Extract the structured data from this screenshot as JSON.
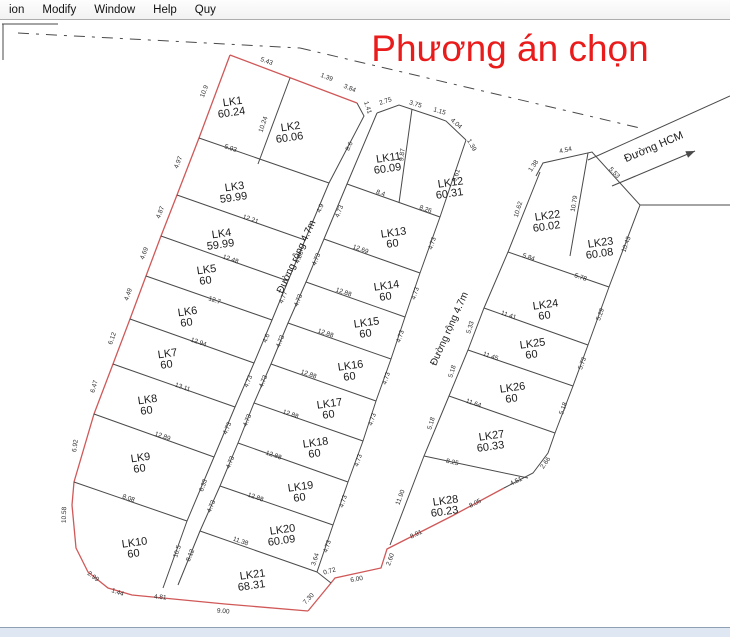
{
  "menu": {
    "items": [
      "ion",
      "Modify",
      "Window",
      "Help",
      "Quy"
    ]
  },
  "title": {
    "text": "Phương án chọn",
    "color": "#ea1b1b"
  },
  "colors": {
    "boundary_red": "#d05858",
    "line_black": "#4a4a4a",
    "bg": "#ffffff"
  },
  "road_labels": [
    {
      "name": "road-1-label",
      "text": "Đường rộng 4.7m",
      "x": 299,
      "y": 258,
      "r": -65
    },
    {
      "name": "road-2-label",
      "text": "Đường rộng 4.7m",
      "x": 452,
      "y": 330,
      "r": -66
    },
    {
      "name": "road-hcm-label",
      "text": "Đường HCM",
      "x": 655,
      "y": 150,
      "r": -23
    }
  ],
  "lots": [
    {
      "id": "LK1",
      "area": "60.24",
      "x": 233,
      "y": 105
    },
    {
      "id": "LK2",
      "area": "60.06",
      "x": 291,
      "y": 130
    },
    {
      "id": "LK3",
      "area": "59.99",
      "x": 235,
      "y": 190
    },
    {
      "id": "LK4",
      "area": "59.99",
      "x": 222,
      "y": 237
    },
    {
      "id": "LK5",
      "area": "60",
      "x": 207,
      "y": 273
    },
    {
      "id": "LK6",
      "area": "60",
      "x": 188,
      "y": 315
    },
    {
      "id": "LK7",
      "area": "60",
      "x": 168,
      "y": 357
    },
    {
      "id": "LK8",
      "area": "60",
      "x": 148,
      "y": 403
    },
    {
      "id": "LK9",
      "area": "60",
      "x": 141,
      "y": 461
    },
    {
      "id": "LK10",
      "area": "60",
      "x": 135,
      "y": 546
    },
    {
      "id": "LK11",
      "area": "60.09",
      "x": 389,
      "y": 161
    },
    {
      "id": "LK12",
      "area": "60.31",
      "x": 451,
      "y": 186
    },
    {
      "id": "LK13",
      "area": "60",
      "x": 394,
      "y": 236
    },
    {
      "id": "LK14",
      "area": "60",
      "x": 387,
      "y": 289
    },
    {
      "id": "LK15",
      "area": "60",
      "x": 367,
      "y": 326
    },
    {
      "id": "LK16",
      "area": "60",
      "x": 351,
      "y": 369
    },
    {
      "id": "LK17",
      "area": "60",
      "x": 330,
      "y": 407
    },
    {
      "id": "LK18",
      "area": "60",
      "x": 316,
      "y": 446
    },
    {
      "id": "LK19",
      "area": "60",
      "x": 301,
      "y": 490
    },
    {
      "id": "LK20",
      "area": "60.09",
      "x": 283,
      "y": 533
    },
    {
      "id": "LK21",
      "area": "68.31",
      "x": 253,
      "y": 578
    },
    {
      "id": "LK22",
      "area": "60.02",
      "x": 548,
      "y": 219
    },
    {
      "id": "LK23",
      "area": "60.08",
      "x": 601,
      "y": 246
    },
    {
      "id": "LK24",
      "area": "60",
      "x": 546,
      "y": 308
    },
    {
      "id": "LK25",
      "area": "60",
      "x": 533,
      "y": 347
    },
    {
      "id": "LK26",
      "area": "60",
      "x": 513,
      "y": 391
    },
    {
      "id": "LK27",
      "area": "60.33",
      "x": 492,
      "y": 439
    },
    {
      "id": "LK28",
      "area": "60.23",
      "x": 446,
      "y": 504
    }
  ],
  "dims": [
    {
      "t": "5.43",
      "x": 266,
      "y": 63,
      "r": 20
    },
    {
      "t": "1.39",
      "x": 326,
      "y": 79,
      "r": 21
    },
    {
      "t": "3.84",
      "x": 349,
      "y": 90,
      "r": 23
    },
    {
      "t": "1.41",
      "x": 366,
      "y": 108,
      "r": 72
    },
    {
      "t": "10.9",
      "x": 206,
      "y": 92,
      "r": -69
    },
    {
      "t": "10.24",
      "x": 265,
      "y": 125,
      "r": -71
    },
    {
      "t": "4.97",
      "x": 180,
      "y": 163,
      "r": -69
    },
    {
      "t": "4.87",
      "x": 162,
      "y": 213,
      "r": -69
    },
    {
      "t": "4.69",
      "x": 146,
      "y": 254,
      "r": -69
    },
    {
      "t": "4.49",
      "x": 130,
      "y": 295,
      "r": -70
    },
    {
      "t": "6.12",
      "x": 114,
      "y": 339,
      "r": -70
    },
    {
      "t": "6.47",
      "x": 96,
      "y": 387,
      "r": -74
    },
    {
      "t": "6.92",
      "x": 77,
      "y": 446,
      "r": -82
    },
    {
      "t": "10.58",
      "x": 66,
      "y": 515,
      "r": -88
    },
    {
      "t": "2.99",
      "x": 92,
      "y": 578,
      "r": 38
    },
    {
      "t": "1.44",
      "x": 117,
      "y": 594,
      "r": 20
    },
    {
      "t": "4.81",
      "x": 160,
      "y": 599,
      "r": 5
    },
    {
      "t": "9.00",
      "x": 223,
      "y": 613,
      "r": 5
    },
    {
      "t": "7.30",
      "x": 310,
      "y": 600,
      "r": -47
    },
    {
      "t": "0.72",
      "x": 330,
      "y": 573,
      "r": -15
    },
    {
      "t": "6.00",
      "x": 357,
      "y": 581,
      "r": -10
    },
    {
      "t": "2.60",
      "x": 392,
      "y": 560,
      "r": -70
    },
    {
      "t": "8.91",
      "x": 417,
      "y": 536,
      "r": -26
    },
    {
      "t": "8.05",
      "x": 476,
      "y": 505,
      "r": -27
    },
    {
      "t": "4.51",
      "x": 517,
      "y": 483,
      "r": -26
    },
    {
      "t": "2.66",
      "x": 547,
      "y": 464,
      "r": -55
    },
    {
      "t": "5.93",
      "x": 230,
      "y": 150,
      "r": 19
    },
    {
      "t": "12.21",
      "x": 250,
      "y": 221,
      "r": 19
    },
    {
      "t": "12.48",
      "x": 230,
      "y": 261,
      "r": 19
    },
    {
      "t": "12.7",
      "x": 214,
      "y": 302,
      "r": 19
    },
    {
      "t": "12.94",
      "x": 198,
      "y": 344,
      "r": 19
    },
    {
      "t": "13.11",
      "x": 182,
      "y": 389,
      "r": 19
    },
    {
      "t": "12.89",
      "x": 162,
      "y": 438,
      "r": 19
    },
    {
      "t": "8.08",
      "x": 128,
      "y": 500,
      "r": 19
    },
    {
      "t": "8.6",
      "x": 351,
      "y": 147,
      "r": -66
    },
    {
      "t": "4.9",
      "x": 322,
      "y": 209,
      "r": -67
    },
    {
      "t": "4.86",
      "x": 301,
      "y": 258,
      "r": -67
    },
    {
      "t": "4.77",
      "x": 285,
      "y": 298,
      "r": -67
    },
    {
      "t": "4.6",
      "x": 268,
      "y": 339,
      "r": -67
    },
    {
      "t": "4.73",
      "x": 250,
      "y": 382,
      "r": -67
    },
    {
      "t": "4.73",
      "x": 229,
      "y": 429,
      "r": -67
    },
    {
      "t": "6.33",
      "x": 205,
      "y": 486,
      "r": -70
    },
    {
      "t": "10.5",
      "x": 179,
      "y": 552,
      "r": -72
    },
    {
      "t": "2.75",
      "x": 386,
      "y": 103,
      "r": -18
    },
    {
      "t": "3.75",
      "x": 415,
      "y": 106,
      "r": 16
    },
    {
      "t": "1.15",
      "x": 439,
      "y": 113,
      "r": 17
    },
    {
      "t": "4.04",
      "x": 455,
      "y": 125,
      "r": 42
    },
    {
      "t": "1.39",
      "x": 470,
      "y": 146,
      "r": 60
    },
    {
      "t": "9.87",
      "x": 404,
      "y": 155,
      "r": -83
    },
    {
      "t": "8.4",
      "x": 380,
      "y": 195,
      "r": 19
    },
    {
      "t": "8.26",
      "x": 425,
      "y": 211,
      "r": 19
    },
    {
      "t": "12.69",
      "x": 360,
      "y": 251,
      "r": 19
    },
    {
      "t": "12.88",
      "x": 343,
      "y": 294,
      "r": 19
    },
    {
      "t": "12.88",
      "x": 325,
      "y": 335,
      "r": 19
    },
    {
      "t": "12.88",
      "x": 308,
      "y": 376,
      "r": 19
    },
    {
      "t": "12.88",
      "x": 290,
      "y": 416,
      "r": 19
    },
    {
      "t": "12.88",
      "x": 273,
      "y": 457,
      "r": 19
    },
    {
      "t": "12.88",
      "x": 255,
      "y": 499,
      "r": 19
    },
    {
      "t": "11.38",
      "x": 240,
      "y": 543,
      "r": 19
    },
    {
      "t": "4.73",
      "x": 341,
      "y": 212,
      "r": -68
    },
    {
      "t": "4.73",
      "x": 318,
      "y": 260,
      "r": -68
    },
    {
      "t": "4.73",
      "x": 300,
      "y": 301,
      "r": -68
    },
    {
      "t": "4.73",
      "x": 282,
      "y": 342,
      "r": -68
    },
    {
      "t": "4.73",
      "x": 265,
      "y": 382,
      "r": -68
    },
    {
      "t": "4.73",
      "x": 249,
      "y": 421,
      "r": -68
    },
    {
      "t": "4.73",
      "x": 232,
      "y": 463,
      "r": -68
    },
    {
      "t": "4.73",
      "x": 213,
      "y": 507,
      "r": -68
    },
    {
      "t": "8.12",
      "x": 192,
      "y": 556,
      "r": -68
    },
    {
      "t": "9.61",
      "x": 458,
      "y": 176,
      "r": -72
    },
    {
      "t": "4.73",
      "x": 434,
      "y": 244,
      "r": -72
    },
    {
      "t": "4.73",
      "x": 417,
      "y": 294,
      "r": -72
    },
    {
      "t": "4.73",
      "x": 402,
      "y": 337,
      "r": -72
    },
    {
      "t": "4.73",
      "x": 388,
      "y": 379,
      "r": -72
    },
    {
      "t": "4.73",
      "x": 374,
      "y": 420,
      "r": -72
    },
    {
      "t": "4.73",
      "x": 360,
      "y": 461,
      "r": -72
    },
    {
      "t": "4.73",
      "x": 345,
      "y": 502,
      "r": -72
    },
    {
      "t": "4.73",
      "x": 329,
      "y": 547,
      "r": -72
    },
    {
      "t": "3.64",
      "x": 317,
      "y": 560,
      "r": -72
    },
    {
      "t": "1.38",
      "x": 535,
      "y": 167,
      "r": -55
    },
    {
      "t": "4.54",
      "x": 566,
      "y": 152,
      "r": -12
    },
    {
      "t": "5.53",
      "x": 613,
      "y": 174,
      "r": 46
    },
    {
      "t": "10.79",
      "x": 576,
      "y": 204,
      "r": -80
    },
    {
      "t": "5.84",
      "x": 528,
      "y": 259,
      "r": 19
    },
    {
      "t": "5.78",
      "x": 580,
      "y": 279,
      "r": 19
    },
    {
      "t": "11.41",
      "x": 508,
      "y": 317,
      "r": 19
    },
    {
      "t": "11.45",
      "x": 490,
      "y": 358,
      "r": 19
    },
    {
      "t": "11.64",
      "x": 473,
      "y": 405,
      "r": 19
    },
    {
      "t": "8.25",
      "x": 452,
      "y": 464,
      "r": 12
    },
    {
      "t": "10.62",
      "x": 520,
      "y": 210,
      "r": -73
    },
    {
      "t": "5.33",
      "x": 472,
      "y": 328,
      "r": -73
    },
    {
      "t": "5.18",
      "x": 454,
      "y": 372,
      "r": -73
    },
    {
      "t": "5.18",
      "x": 433,
      "y": 424,
      "r": -73
    },
    {
      "t": "11.90",
      "x": 402,
      "y": 498,
      "r": -70
    },
    {
      "t": "10.43",
      "x": 628,
      "y": 245,
      "r": -70
    },
    {
      "t": "5.29",
      "x": 602,
      "y": 315,
      "r": -70
    },
    {
      "t": "5.73",
      "x": 584,
      "y": 364,
      "r": -70
    },
    {
      "t": "5.18",
      "x": 565,
      "y": 409,
      "r": -70
    }
  ],
  "lines": {
    "red": [
      [
        [
          230,
          55
        ],
        [
          312,
          86
        ],
        [
          357,
          103
        ]
      ],
      [
        [
          230,
          55
        ],
        [
          199,
          138
        ],
        [
          177,
          195
        ],
        [
          161,
          236
        ],
        [
          146,
          276
        ],
        [
          130,
          319
        ],
        [
          113,
          364
        ],
        [
          94,
          414
        ],
        [
          74,
          482
        ],
        [
          72,
          505
        ],
        [
          76,
          548
        ],
        [
          88,
          572
        ],
        [
          108,
          588
        ],
        [
          132,
          595
        ],
        [
          225,
          604
        ],
        [
          308,
          611
        ]
      ],
      [
        [
          308,
          611
        ],
        [
          331,
          583
        ],
        [
          335,
          578
        ],
        [
          381,
          568
        ],
        [
          387,
          549
        ],
        [
          452,
          516
        ],
        [
          504,
          488
        ]
      ]
    ],
    "black": [
      [
        [
          357,
          103
        ],
        [
          364,
          116
        ],
        [
          329,
          183
        ],
        [
          305,
          240
        ],
        [
          288,
          281
        ],
        [
          272,
          320
        ],
        [
          254,
          363
        ],
        [
          235,
          407
        ],
        [
          214,
          457
        ],
        [
          187,
          521
        ],
        [
          163,
          588
        ]
      ],
      [
        [
          377,
          113
        ],
        [
          347,
          184
        ],
        [
          324,
          239
        ],
        [
          306,
          282
        ],
        [
          288,
          323
        ],
        [
          271,
          364
        ],
        [
          254,
          403
        ],
        [
          238,
          443
        ],
        [
          220,
          486
        ],
        [
          200,
          531
        ],
        [
          178,
          585
        ]
      ],
      [
        [
          466,
          140
        ],
        [
          440,
          217
        ],
        [
          420,
          273
        ],
        [
          405,
          317
        ],
        [
          391,
          359
        ],
        [
          376,
          401
        ],
        [
          363,
          441
        ],
        [
          348,
          482
        ],
        [
          333,
          525
        ],
        [
          317,
          572
        ],
        [
          331,
          583
        ]
      ],
      [
        [
          540,
          172
        ],
        [
          508,
          252
        ],
        [
          484,
          308
        ],
        [
          468,
          350
        ],
        [
          449,
          396
        ],
        [
          424,
          456
        ],
        [
          390,
          545
        ]
      ],
      [
        [
          536,
          176
        ],
        [
          543,
          163
        ],
        [
          592,
          152
        ],
        [
          640,
          205
        ],
        [
          609,
          287
        ],
        [
          588,
          345
        ],
        [
          573,
          386
        ],
        [
          555,
          433
        ],
        [
          548,
          453
        ],
        [
          533,
          473
        ],
        [
          504,
          488
        ]
      ],
      [
        [
          377,
          113
        ],
        [
          399,
          105
        ],
        [
          435,
          117
        ],
        [
          446,
          121
        ],
        [
          466,
          140
        ]
      ],
      [
        [
          588,
          160
        ],
        [
          730,
          96
        ]
      ],
      [
        [
          640,
          205
        ],
        [
          730,
          205
        ]
      ],
      [
        [
          2,
          24
        ],
        [
          58,
          24
        ]
      ],
      [
        [
          3,
          24
        ],
        [
          3,
          60
        ]
      ],
      [
        [
          290,
          78
        ],
        [
          258,
          164
        ]
      ],
      [
        [
          199,
          138
        ],
        [
          329,
          183
        ]
      ],
      [
        [
          177,
          195
        ],
        [
          305,
          240
        ]
      ],
      [
        [
          161,
          236
        ],
        [
          288,
          281
        ]
      ],
      [
        [
          146,
          276
        ],
        [
          272,
          320
        ]
      ],
      [
        [
          130,
          319
        ],
        [
          254,
          363
        ]
      ],
      [
        [
          113,
          364
        ],
        [
          235,
          407
        ]
      ],
      [
        [
          94,
          414
        ],
        [
          214,
          457
        ]
      ],
      [
        [
          74,
          482
        ],
        [
          187,
          521
        ]
      ],
      [
        [
          412,
          109
        ],
        [
          399,
          203
        ]
      ],
      [
        [
          347,
          184
        ],
        [
          440,
          217
        ]
      ],
      [
        [
          324,
          239
        ],
        [
          420,
          273
        ]
      ],
      [
        [
          306,
          282
        ],
        [
          405,
          317
        ]
      ],
      [
        [
          288,
          323
        ],
        [
          391,
          359
        ]
      ],
      [
        [
          271,
          364
        ],
        [
          376,
          401
        ]
      ],
      [
        [
          254,
          403
        ],
        [
          363,
          441
        ]
      ],
      [
        [
          238,
          443
        ],
        [
          348,
          482
        ]
      ],
      [
        [
          220,
          486
        ],
        [
          333,
          525
        ]
      ],
      [
        [
          200,
          531
        ],
        [
          317,
          572
        ]
      ],
      [
        [
          588,
          153
        ],
        [
          570,
          256
        ]
      ],
      [
        [
          508,
          252
        ],
        [
          609,
          287
        ]
      ],
      [
        [
          484,
          308
        ],
        [
          588,
          345
        ]
      ],
      [
        [
          468,
          350
        ],
        [
          573,
          386
        ]
      ],
      [
        [
          449,
          396
        ],
        [
          555,
          433
        ]
      ],
      [
        [
          424,
          456
        ],
        [
          528,
          478
        ]
      ]
    ],
    "dashed": [
      [
        [
          18,
          33
        ],
        [
          300,
          48
        ]
      ],
      [
        [
          300,
          48
        ],
        [
          640,
          128
        ]
      ]
    ],
    "arrow": {
      "from": [
        612,
        186
      ],
      "to": [
        695,
        151
      ]
    }
  }
}
